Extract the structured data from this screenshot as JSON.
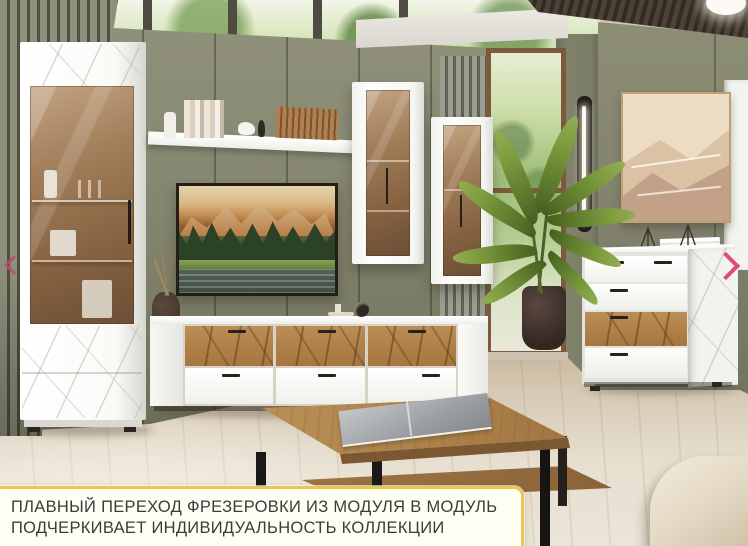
{
  "ui": {
    "caption": {
      "line1": "ПЛАВНЫЙ ПЕРЕХОД ФРЕЗЕРОВКИ ИЗ МОДУЛЯ В МОДУЛЬ",
      "line2": "ПОДЧЕРКИВАЕТ ИНДИВИДУАЛЬНОСТЬ КОЛЛЕКЦИИ"
    },
    "arrows": {
      "prev_glyph": "‹",
      "next_glyph": "›",
      "color": "#e04a7c"
    },
    "colors": {
      "caption_border": "#e8c94e",
      "caption_background": "#fffef4",
      "caption_text": "#3b3b3b"
    }
  },
  "scene": {
    "description": "3D rendered living room with modular furniture collection: white gloss units with oak milled fronts",
    "objects": [
      "tall-display-cabinet-with-amber-glass-door",
      "wall-shelf-with-books-and-slat-decor",
      "tv-with-mountain-forest-landscape",
      "hanging-glass-cabinet-left",
      "hanging-glass-cabinet-right",
      "tv-stand-with-oak-drawers",
      "chest-of-drawers",
      "desert-dunes-wall-art",
      "led-bar-wall-lamp",
      "potted-palm-plant",
      "coffee-table-with-magazine",
      "beige-pouf",
      "dried-sprig-vase",
      "sage-green-panel-wall",
      "slatted-wood-ceiling",
      "clerestory-windows"
    ],
    "colors": {
      "wall_green": "#87876f",
      "furniture_white": "#fbfbf8",
      "oak_wood": "#b3874f",
      "glass_amber": "#a9846b",
      "floor_light": "#e6dfd1",
      "ceiling_wood": "#473d32",
      "plant_green": "#6d8f3a",
      "metal_black": "#1f1d1b",
      "window_green": "#9fbd77"
    }
  }
}
